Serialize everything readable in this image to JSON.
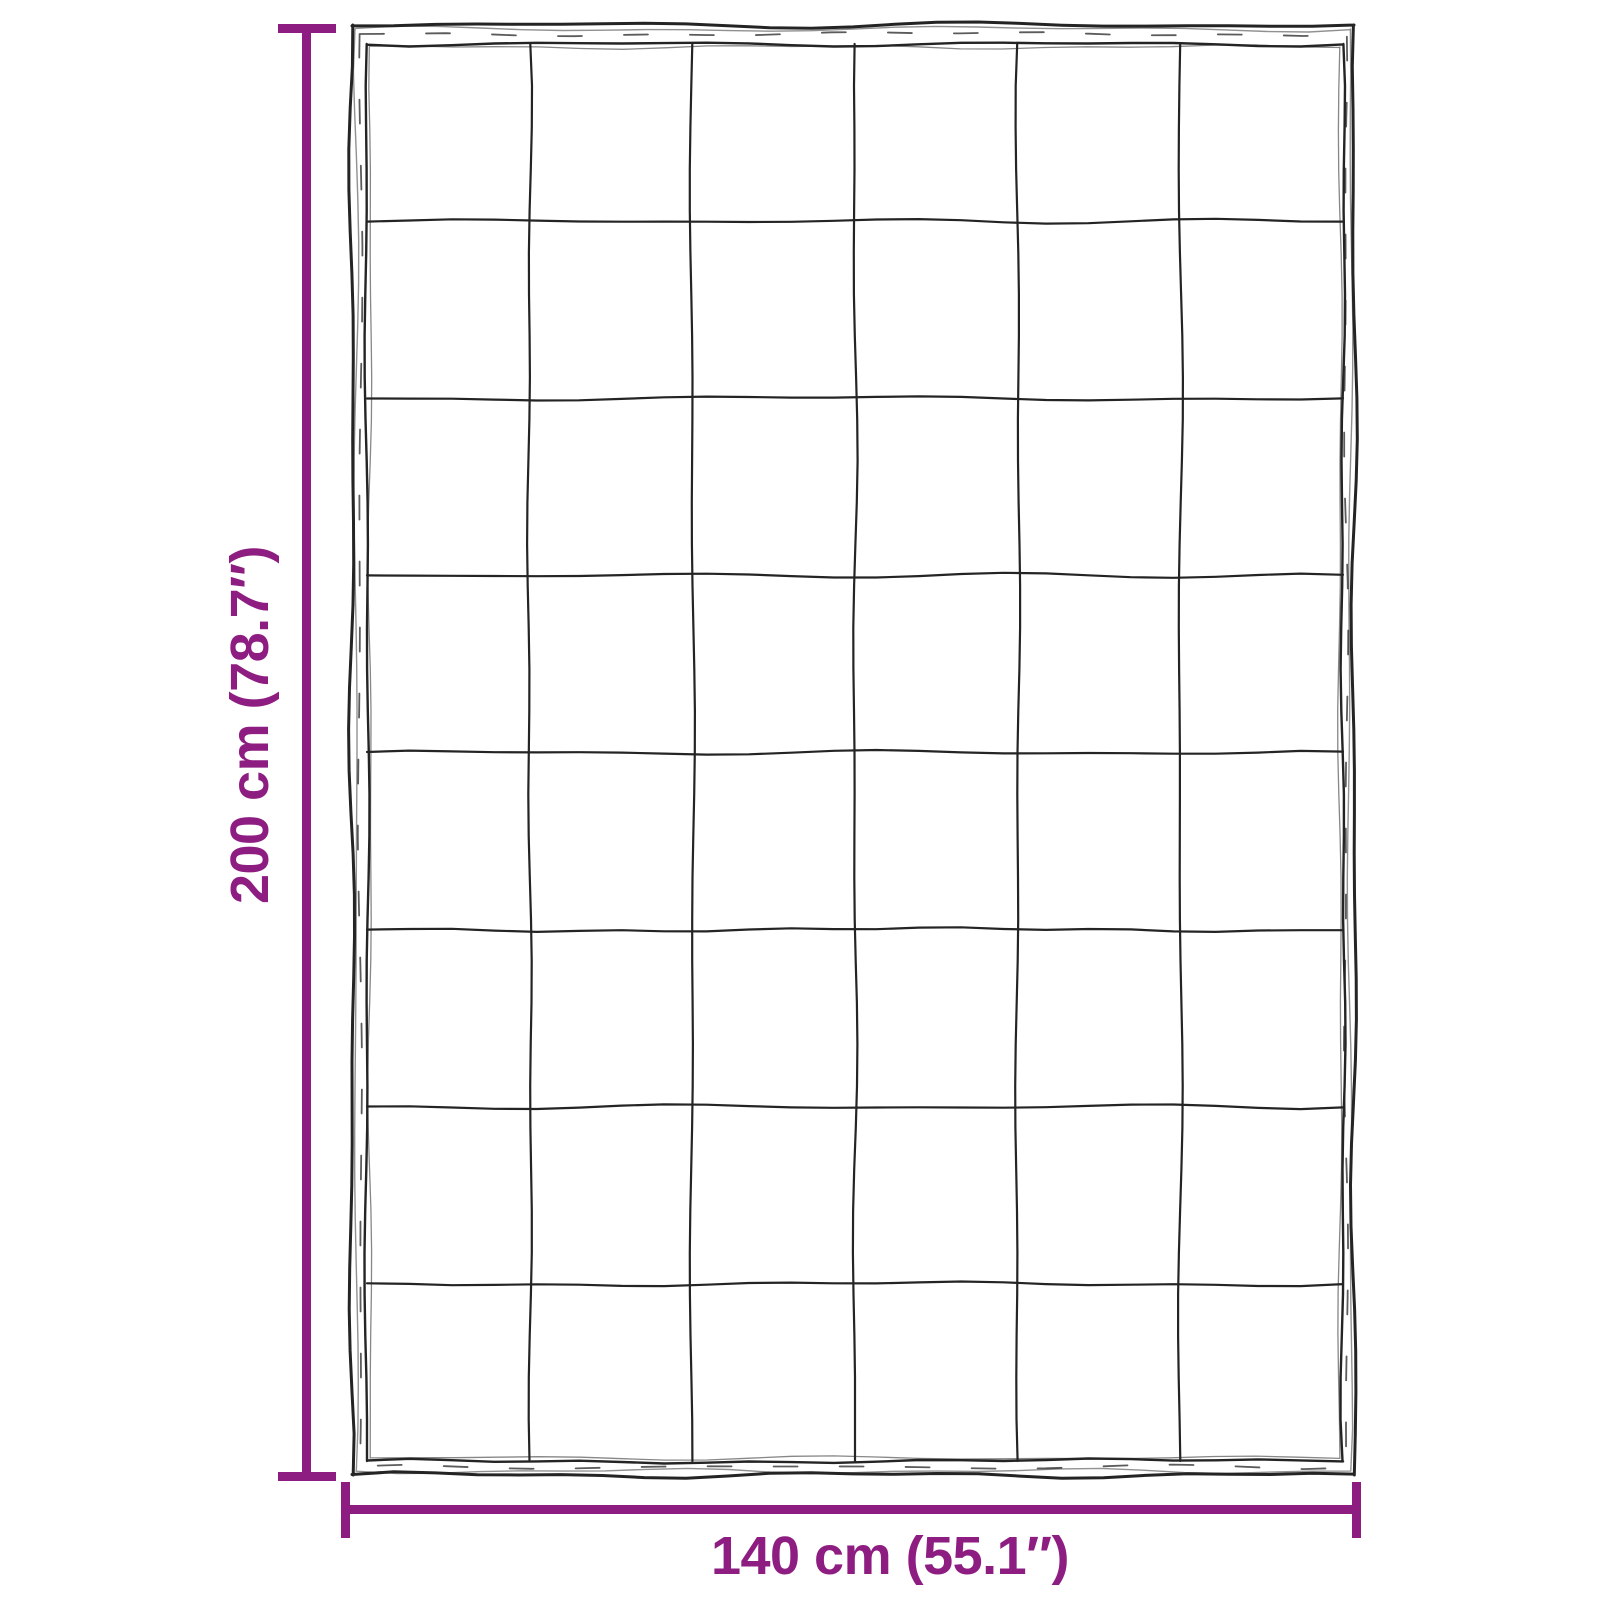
{
  "diagram": {
    "kind": "quilted-blanket-dimension-sketch",
    "blanket_grid": {
      "columns": 6,
      "rows": 8
    },
    "colors": {
      "dimension_accent": "#8E1D82",
      "sketch_ink": "#242424",
      "background": "#FFFFFF"
    },
    "height_dimension": {
      "label": "200 cm (78.7″)",
      "value_cm": 200,
      "value_inches": 78.7
    },
    "width_dimension": {
      "label": "140 cm (55.1″)",
      "value_cm": 140,
      "value_inches": 55.1
    }
  }
}
